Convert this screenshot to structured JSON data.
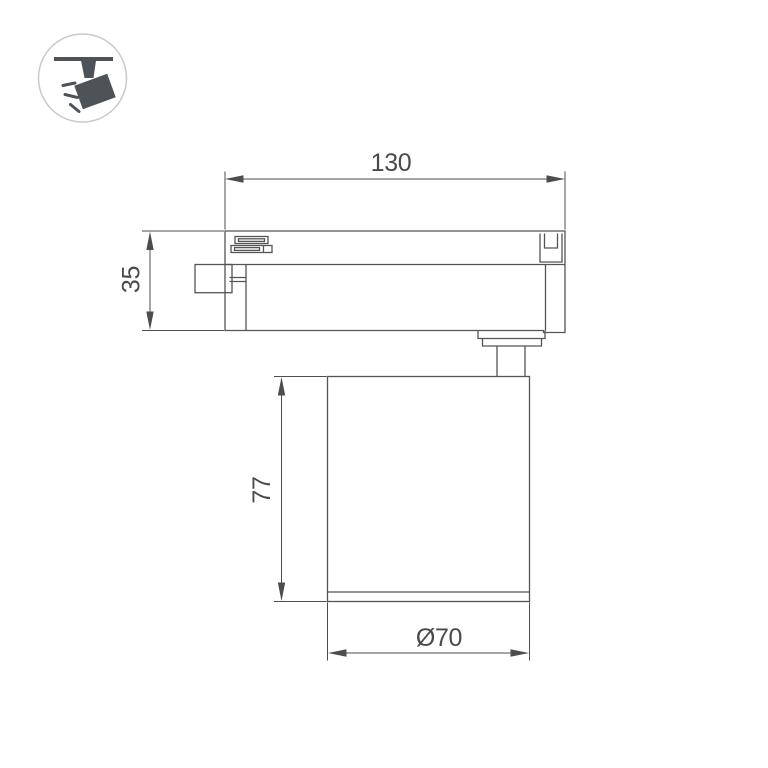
{
  "page": {
    "background_color": "#ffffff"
  },
  "colors": {
    "outline": "#545454",
    "dimension": "#4d4d4d",
    "text": "#4a4a4a",
    "icon_glyph": "#4d5358",
    "icon_circle_border": "#c7c9cb",
    "icon_circle_fill": "#ffffff"
  },
  "icon": {
    "name": "track-spotlight-pictogram"
  },
  "drawing": {
    "type": "technical-dimension-drawing",
    "dimensions": {
      "overall_width": {
        "label": "130"
      },
      "track_adapter_height": {
        "label": "35"
      },
      "lamp_body_height": {
        "label": "77"
      },
      "lamp_body_diameter": {
        "label": "Ø70"
      }
    }
  }
}
